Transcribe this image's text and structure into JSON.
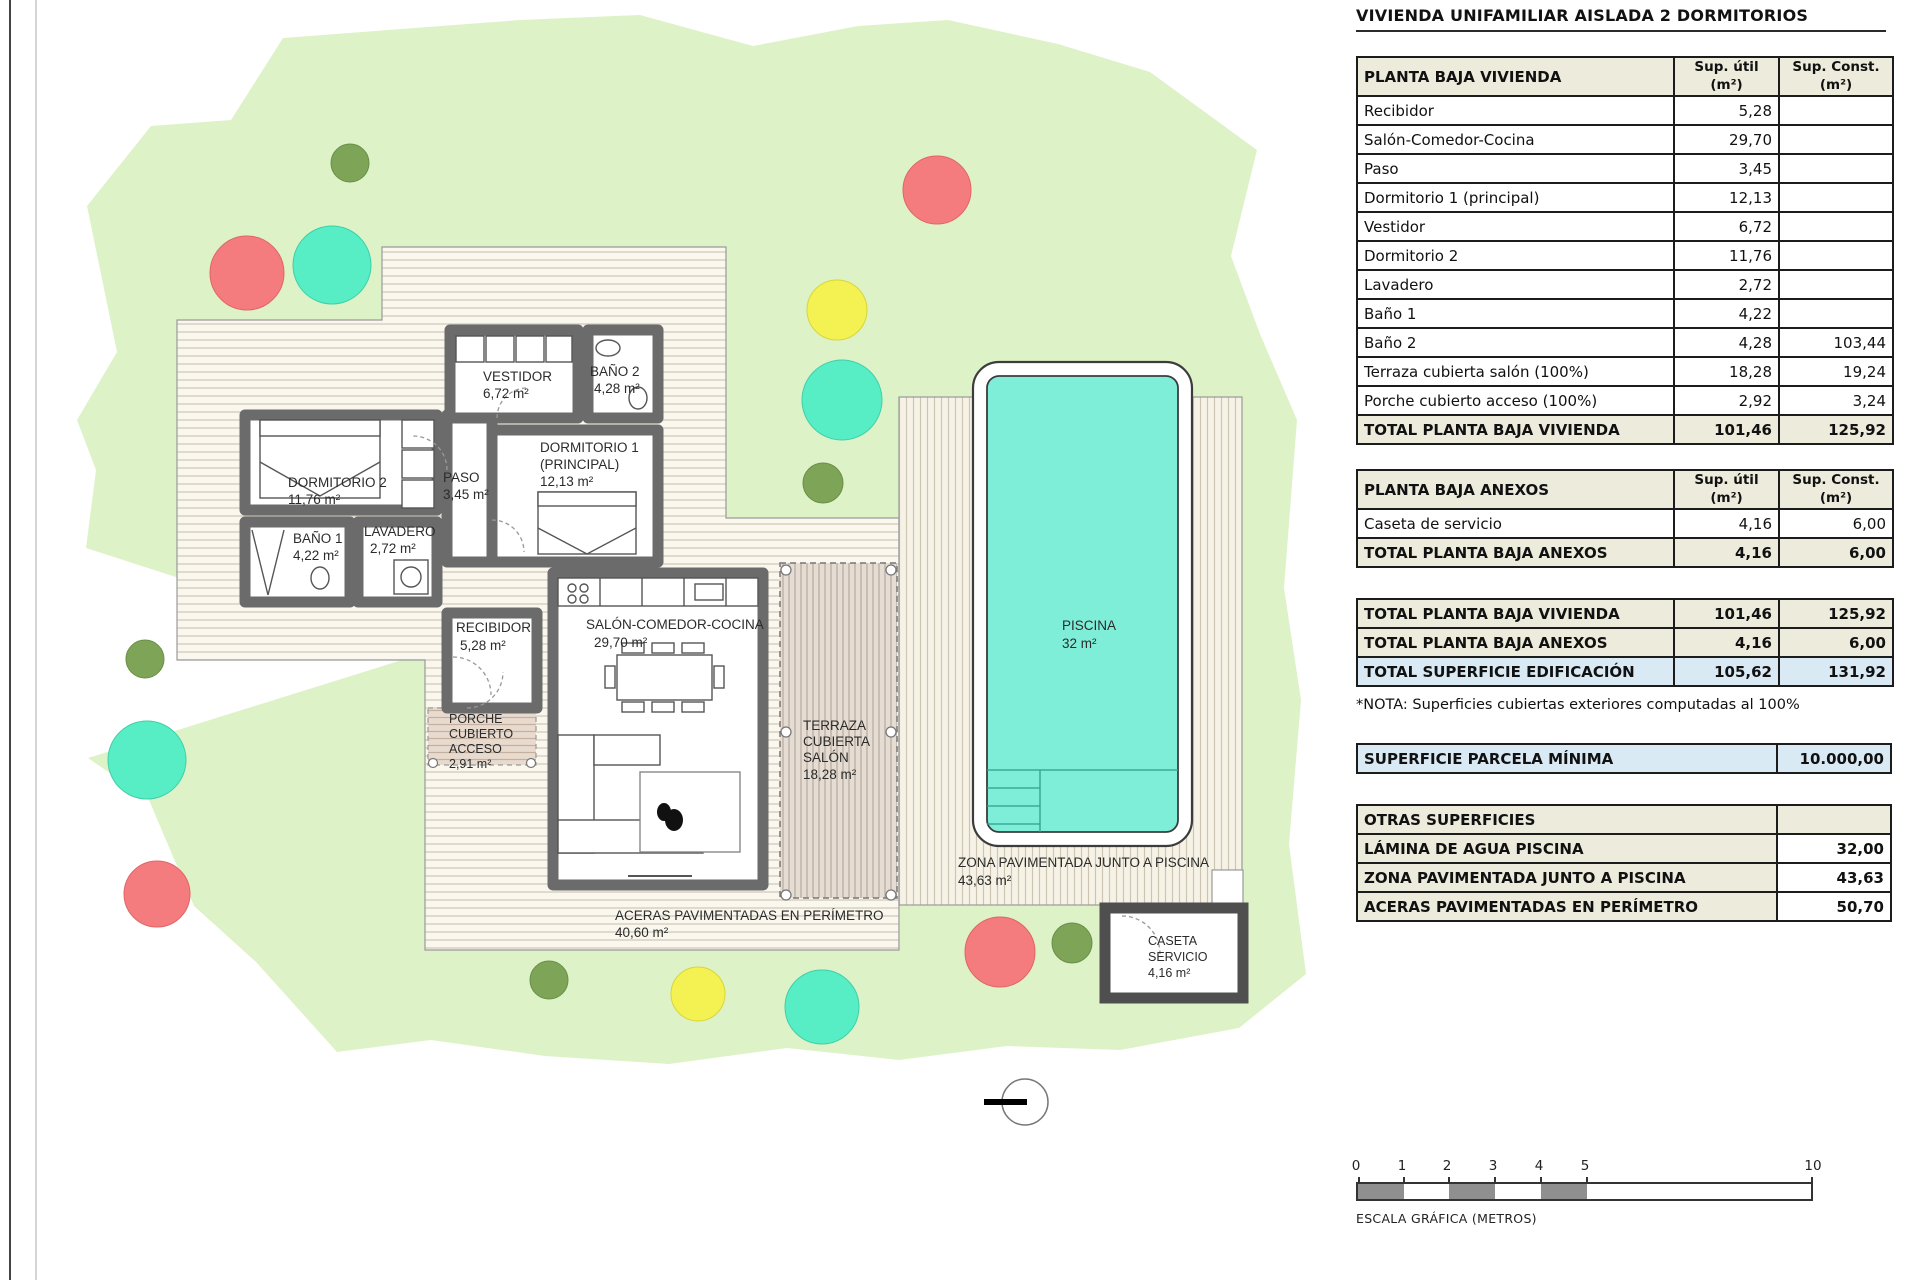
{
  "title": "VIVIENDA UNIFAMILIAR AISLADA 2 DORMITORIOS",
  "cols": {
    "util_l1": "Sup. útil",
    "util_l2": "(m²)",
    "const_l1": "Sup. Const.",
    "const_l2": "(m²)"
  },
  "vivienda": {
    "header": "PLANTA BAJA VIVIENDA",
    "rows": [
      {
        "label": "Recibidor",
        "util": "5,28",
        "const": ""
      },
      {
        "label": "Salón-Comedor-Cocina",
        "util": "29,70",
        "const": ""
      },
      {
        "label": "Paso",
        "util": "3,45",
        "const": ""
      },
      {
        "label": "Dormitorio 1 (principal)",
        "util": "12,13",
        "const": ""
      },
      {
        "label": "Vestidor",
        "util": "6,72",
        "const": ""
      },
      {
        "label": "Dormitorio 2",
        "util": "11,76",
        "const": ""
      },
      {
        "label": "Lavadero",
        "util": "2,72",
        "const": ""
      },
      {
        "label": "Baño 1",
        "util": "4,22",
        "const": ""
      },
      {
        "label": "Baño 2",
        "util": "4,28",
        "const": "103,44"
      },
      {
        "label": "Terraza cubierta salón (100%)",
        "util": "18,28",
        "const": "19,24"
      },
      {
        "label": "Porche cubierto acceso (100%)",
        "util": "2,92",
        "const": "3,24"
      }
    ],
    "total": {
      "label": "TOTAL PLANTA BAJA VIVIENDA",
      "util": "101,46",
      "const": "125,92"
    }
  },
  "anexos": {
    "header": "PLANTA BAJA ANEXOS",
    "rows": [
      {
        "label": "Caseta de servicio",
        "util": "4,16",
        "const": "6,00"
      }
    ],
    "total": {
      "label": "TOTAL PLANTA BAJA ANEXOS",
      "util": "4,16",
      "const": "6,00"
    }
  },
  "resumen": {
    "rows": [
      {
        "label": "TOTAL PLANTA BAJA VIVIENDA",
        "util": "101,46",
        "const": "125,92"
      },
      {
        "label": "TOTAL PLANTA BAJA ANEXOS",
        "util": "4,16",
        "const": "6,00"
      },
      {
        "label": "TOTAL SUPERFICIE EDIFICACIÓN",
        "util": "105,62",
        "const": "131,92"
      }
    ]
  },
  "nota": "*NOTA: Superficies cubiertas exteriores computadas al 100%",
  "parcela": {
    "label": "SUPERFICIE PARCELA MÍNIMA",
    "value": "10.000,00"
  },
  "otras": {
    "header": "OTRAS SUPERFICIES",
    "rows": [
      {
        "label": "LÁMINA DE AGUA PISCINA",
        "value": "32,00"
      },
      {
        "label": "ZONA PAVIMENTADA JUNTO A PISCINA",
        "value": "43,63"
      },
      {
        "label": "ACERAS PAVIMENTADAS EN PERÍMETRO",
        "value": "50,70"
      }
    ]
  },
  "scale": {
    "ticks": [
      "0",
      "1",
      "2",
      "3",
      "4",
      "5",
      "10"
    ],
    "caption": "ESCALA GRÁFICA (METROS)"
  },
  "plan": {
    "dorm2": {
      "name": "DORMITORIO 2",
      "area": "11,76 m²"
    },
    "bano1": {
      "name": "BAÑO 1",
      "area": "4,22 m²"
    },
    "lavadero": {
      "name": "LAVADERO",
      "area": "2,72 m²"
    },
    "paso": {
      "name": "PASO",
      "area": "3,45 m²"
    },
    "vestidor": {
      "name": "VESTIDOR",
      "area": "6,72 m²"
    },
    "bano2": {
      "name": "BAÑO 2",
      "area": "4,28 m²"
    },
    "dorm1": {
      "l1": "DORMITORIO 1",
      "l2": "(PRINCIPAL)",
      "area": "12,13 m²"
    },
    "recibidor": {
      "name": "RECIBIDOR",
      "area": "5,28 m²"
    },
    "salon": {
      "name": "SALÓN-COMEDOR-COCINA",
      "area": "29,70 m²"
    },
    "porche": {
      "l1": "PORCHE",
      "l2": "CUBIERTO",
      "l3": "ACCESO",
      "area": "2,91 m²"
    },
    "terraza": {
      "l1": "TERRAZA",
      "l2": "CUBIERTA",
      "l3": "SALÓN",
      "area": "18,28 m²"
    },
    "piscina": {
      "name": "PISCINA",
      "area": "32 m²"
    },
    "zona": {
      "name": "ZONA PAVIMENTADA JUNTO A PISCINA",
      "area": "43,63 m²"
    },
    "aceras": {
      "name": "ACERAS PAVIMENTADAS EN PERÍMETRO",
      "area": "40,60 m²"
    },
    "caseta": {
      "l1": "CASETA",
      "l2": "SERVICIO",
      "area": "4,16 m²"
    }
  },
  "colors": {
    "parcel_green": "#def2c8",
    "deck_cream": "#faf7ee",
    "pool_cyan": "#7eeed8",
    "terraza_tan": "#e5ddd3",
    "wall_gray": "#6b6b6b",
    "table_beige": "#edebdc",
    "table_blue": "#d9eaf5",
    "tree_teal": "#57eec6",
    "tree_red": "#f47c7e",
    "tree_yellow": "#f4f152",
    "tree_olive": "#7ea557",
    "scale_gray": "#8f8f8f"
  }
}
